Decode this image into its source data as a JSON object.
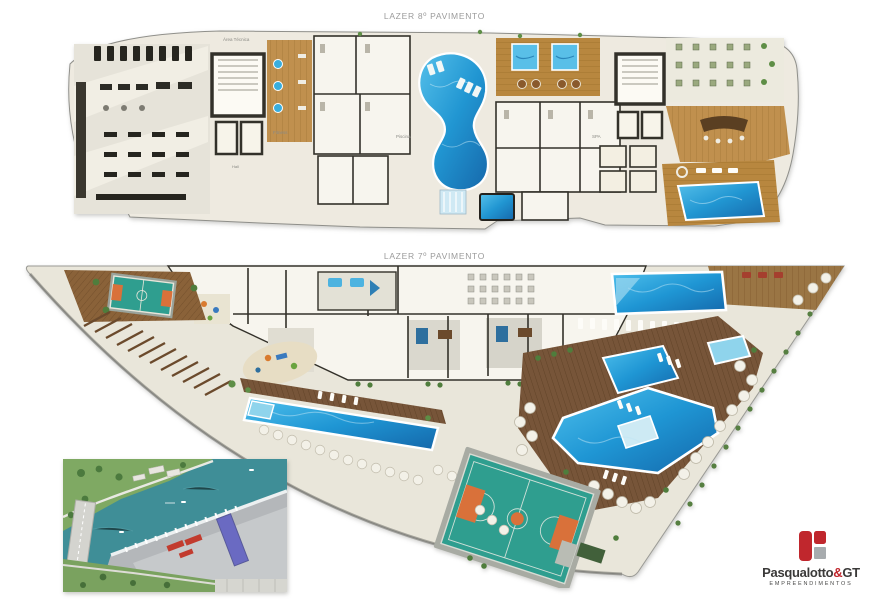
{
  "titles": {
    "floor8": "LAZER 8º PAVIMENTO",
    "floor7": "LAZER 7º PAVIMENTO"
  },
  "floor8_labels": {
    "area_tecnica": "Área Técnica",
    "fitness": "Fitness",
    "piscina": "Piscina",
    "spa": "SPA",
    "hall": "Hall"
  },
  "logo": {
    "brand_main": "Pasqualotto",
    "brand_amp": "&",
    "brand_suffix": "GT",
    "tagline": "EMPREENDIMENTOS"
  },
  "palette": {
    "pool_blue": "#2aa9df",
    "pool_deep": "#1668ab",
    "kids_pool": "#8fd4ec",
    "wood_light": "#c0904e",
    "wood_deck": "#7b5a39",
    "court_teal": "#2f9e8f",
    "court_orange": "#d9713a",
    "walkway": "#e9e6da",
    "rooms_white": "#f7f5ee",
    "wall_dark": "#33312a",
    "water_teal": "#3f8e97",
    "bank_green": "#7fa963",
    "site_gray": "#b4b7ba",
    "roof_violet": "#6a6ac2",
    "roof_red": "#c23b2e",
    "logo_red": "#c0272d",
    "logo_gray": "#a7abae",
    "title_gray": "#9b9b9b"
  }
}
